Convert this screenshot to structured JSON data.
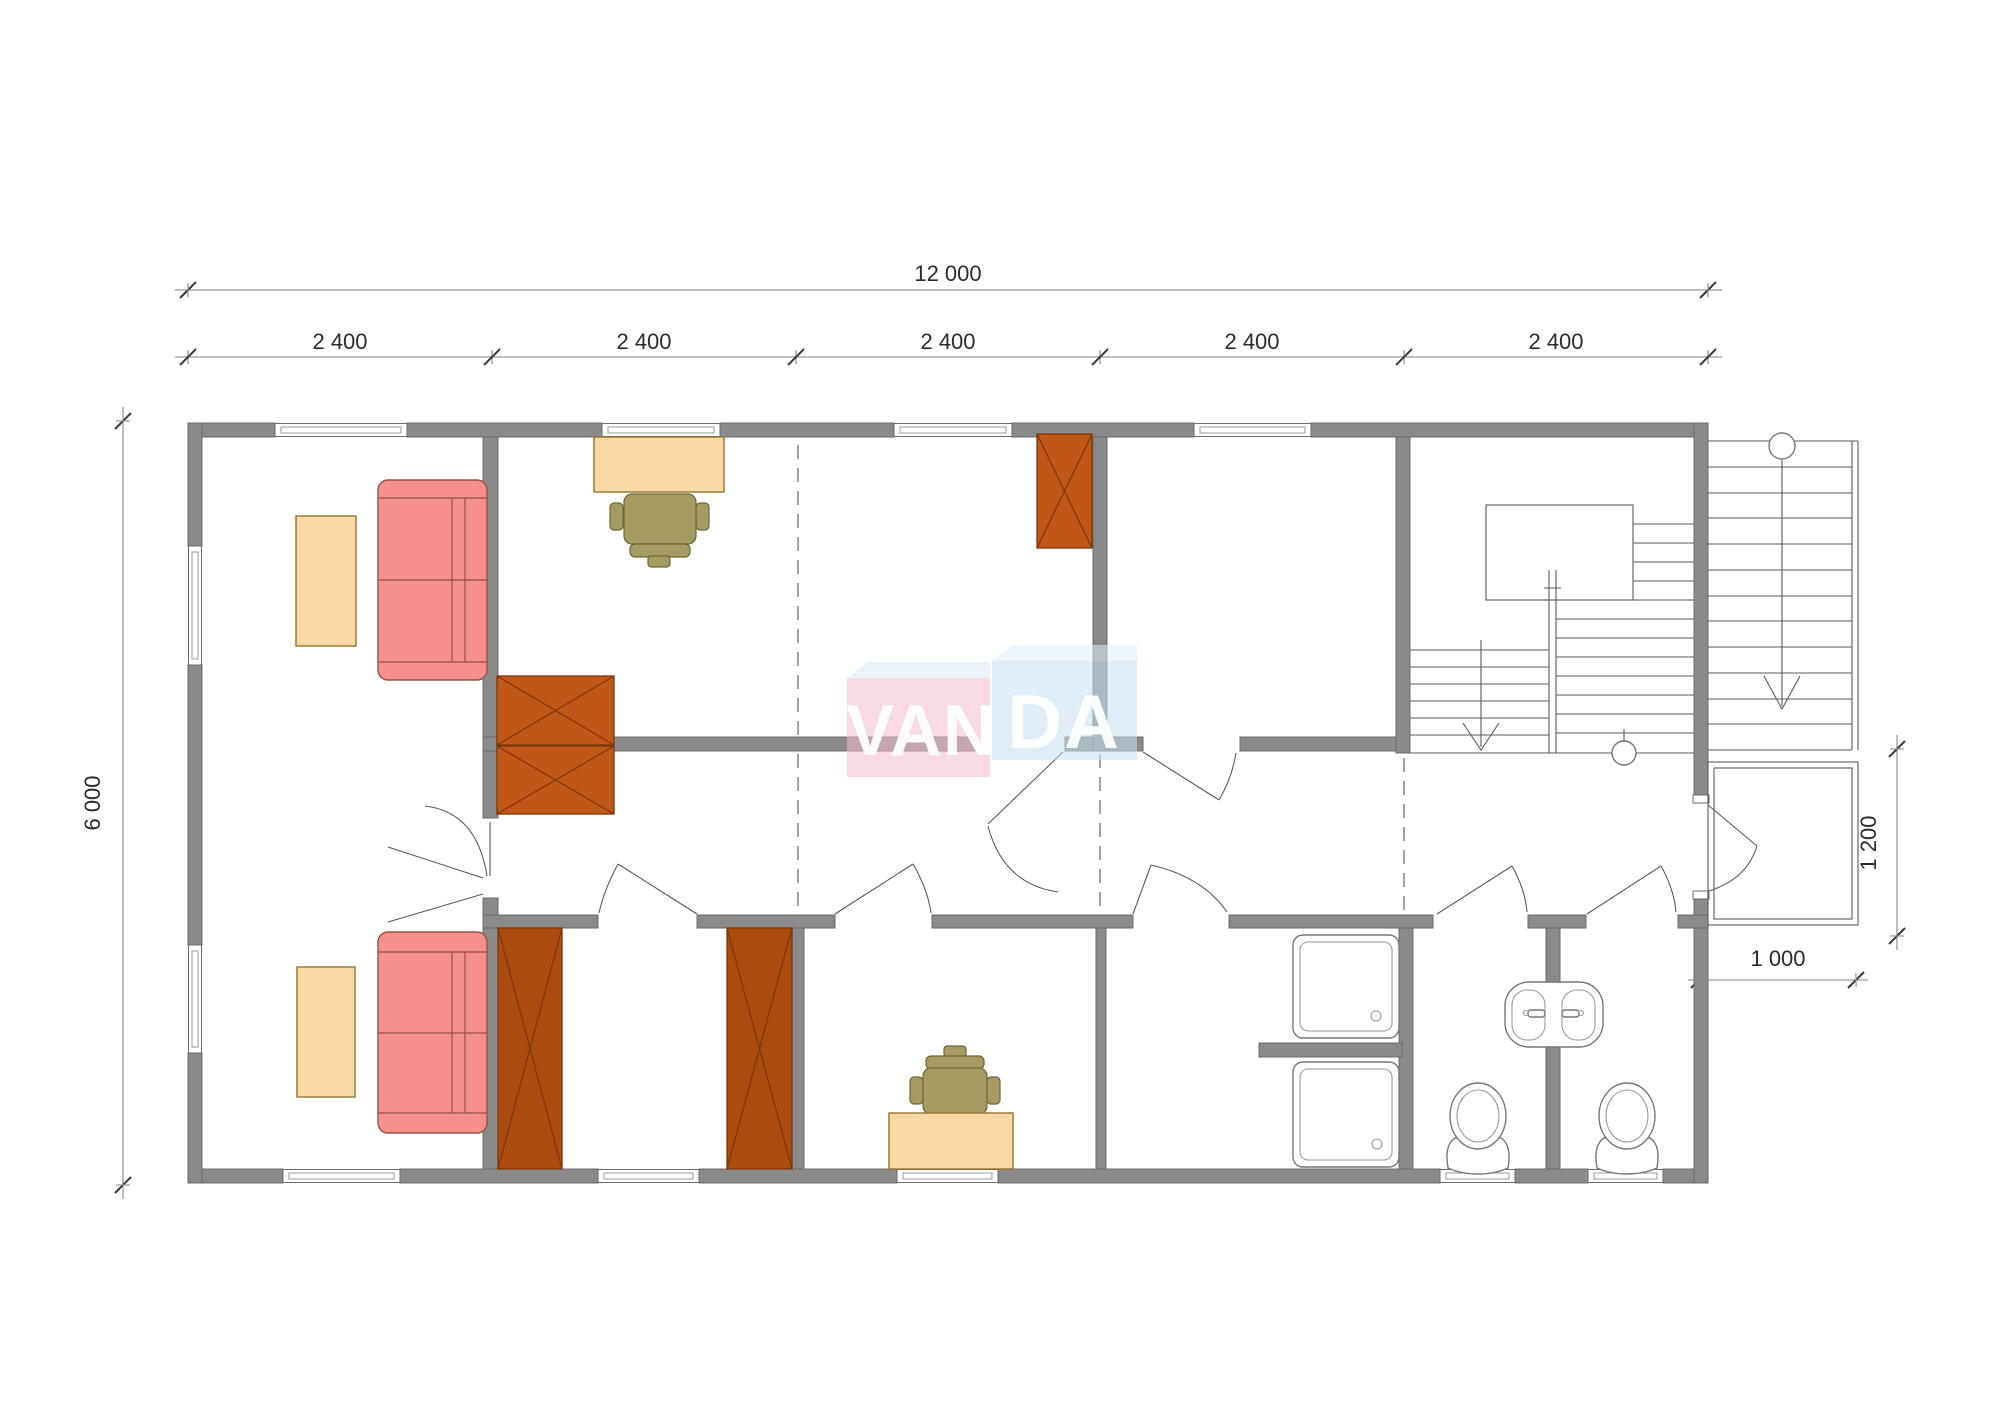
{
  "watermark": {
    "text": "VANDA",
    "text_left": "VAN",
    "text_right": "DA"
  },
  "dimensions": {
    "total_width": "12 000",
    "modules": [
      "2 400",
      "2 400",
      "2 400",
      "2 400",
      "2 400"
    ],
    "total_height": "6 000",
    "annex_depth": "1 200",
    "annex_width": "1 000"
  },
  "colors": {
    "wall": "#8a8a8a",
    "wall_stroke": "#6b6b6b",
    "line": "#5a5a5a",
    "dim_line": "#9a9a9a",
    "dim_text": "#2b2b2b",
    "grid_dash": "#7a7a7a",
    "sofa": "#f5908a",
    "sofa_stroke": "#96524a",
    "table": "#fbd9a6",
    "table_stroke": "#96722e",
    "wardrobe_office": "#c05717",
    "wardrobe_dark": "#ac4b0e",
    "wardrobe_stroke": "#7a3708",
    "chair": "#a49b63",
    "chair_stroke": "#6f6636",
    "fixture_stroke": "#777777",
    "logo_pink": "#f5bccb",
    "logo_blue": "#c7e0f2",
    "logo_bevel_pink": "#dce9f6",
    "logo_bevel_blue": "#ddeffa"
  }
}
